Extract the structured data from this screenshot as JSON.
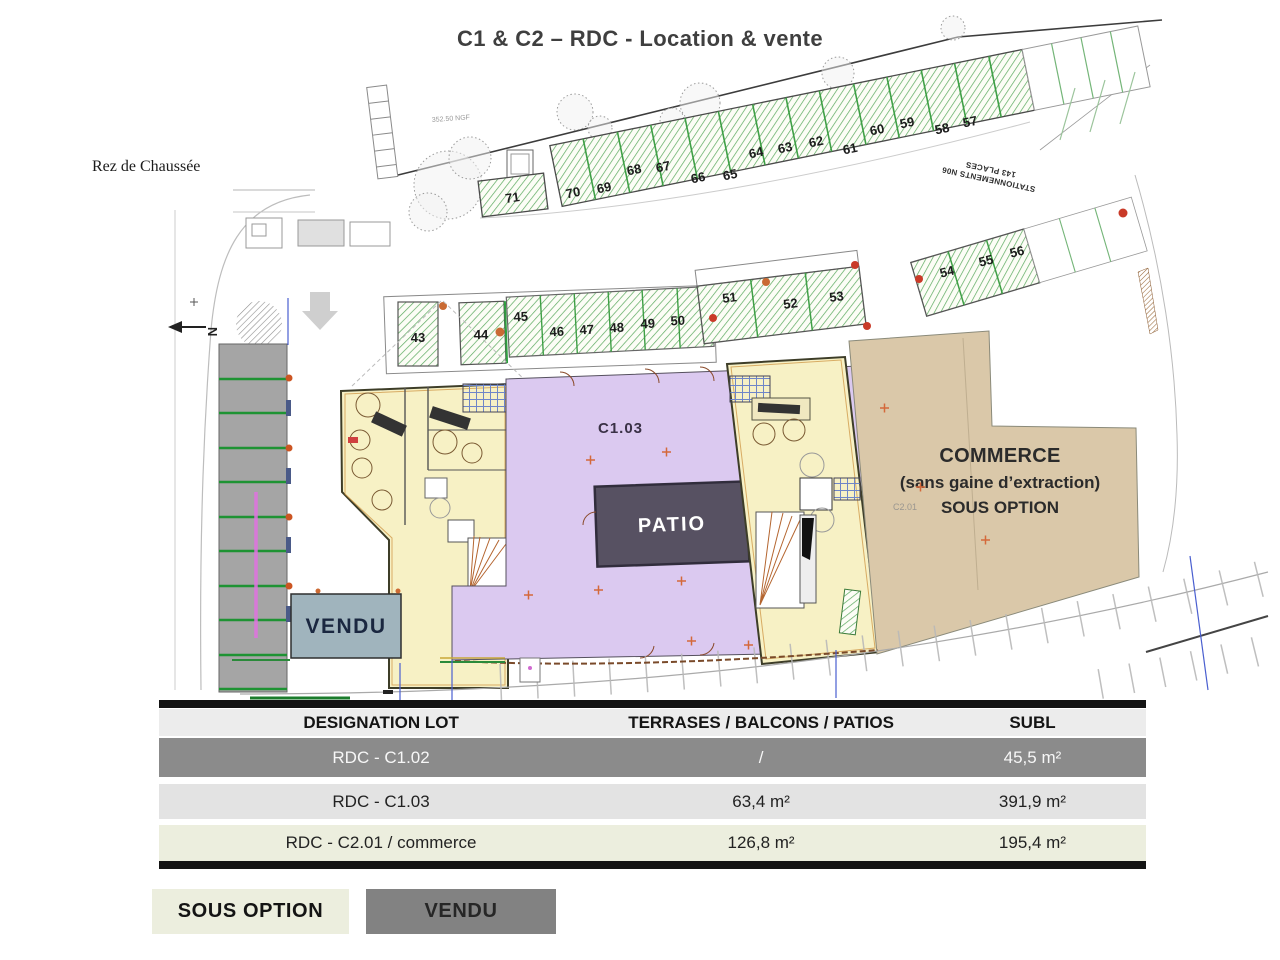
{
  "title": "C1 & C2 – RDC - Location & vente",
  "plan": {
    "floor_label": "Rez de Chaussée",
    "north_label": "N",
    "elevation_label": "352.50 NGF",
    "parking_note": {
      "line1": "STATIONNEMENTS N06",
      "line2": "143 PLACES"
    },
    "stalls_top": [
      "71",
      "70",
      "69",
      "68",
      "67",
      "66",
      "65",
      "64",
      "63",
      "62",
      "61",
      "60",
      "59",
      "58",
      "57"
    ],
    "stalls_mid": [
      "43",
      "44",
      "45",
      "46",
      "47",
      "48",
      "49",
      "50",
      "51",
      "52",
      "53",
      "54",
      "55",
      "56"
    ],
    "zones": {
      "c103": "C1.03",
      "patio": "PATIO",
      "vendu": "VENDU",
      "commerce_line1": "COMMERCE",
      "commerce_line2": "(sans gaine d’extraction)",
      "commerce_line3": "SOUS OPTION",
      "c201": "C2.01"
    }
  },
  "table": {
    "headers": {
      "lot": "DESIGNATION LOT",
      "terrace": "TERRASES / BALCONS / PATIOS",
      "subl": "SUBL"
    },
    "rows": [
      {
        "lot": "RDC - C1.02",
        "terrace": "/",
        "subl": "45,5 m²",
        "status": "vendu"
      },
      {
        "lot": "RDC - C1.03",
        "terrace": "63,4 m²",
        "subl": "391,9 m²",
        "status": ""
      },
      {
        "lot": "RDC - C2.01 / commerce",
        "terrace": "126,8 m²",
        "subl": "195,4 m²",
        "status": "sous option"
      }
    ]
  },
  "legend": {
    "sous_option": "SOUS OPTION",
    "vendu": "VENDU"
  },
  "colors": {
    "building": "#f7f1c5",
    "c103_zone": "#dbc9f0",
    "patio_zone": "#575162",
    "vendu_zone": "#a0b4bd",
    "commerce_zone": "#dac8a9",
    "parking_hatch": "#5aa95e",
    "row_vendu": "#8b8b8b",
    "row_sous_option": "#eceede"
  }
}
